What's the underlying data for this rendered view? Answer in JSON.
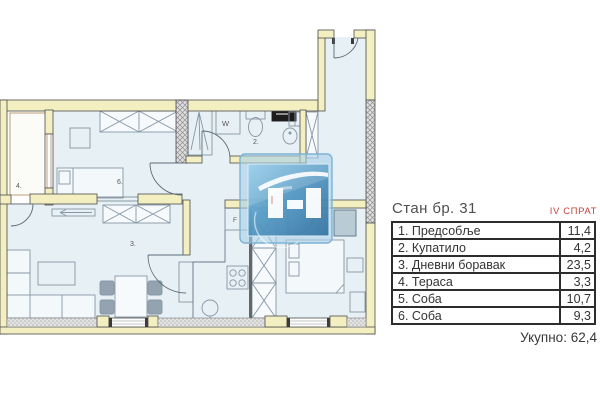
{
  "panel": {
    "title": "Стан бр. 31",
    "floor": "IV СПРАТ",
    "rows": [
      {
        "name": "1. Предсобље",
        "area": "11,4"
      },
      {
        "name": "2. Купатило",
        "area": "4,2"
      },
      {
        "name": "3. Дневни боравак",
        "area": "23,5"
      },
      {
        "name": "4. Тераса",
        "area": "3,3"
      },
      {
        "name": "5. Соба",
        "area": "10,7"
      },
      {
        "name": "6. Соба",
        "area": "9,3"
      }
    ],
    "total_label": "Укупно:",
    "total_value": "62,4"
  },
  "plan": {
    "room_labels": {
      "terrace": "4.",
      "bedroom6": "6.",
      "living": "3.",
      "bathroom": "2."
    },
    "appliance_labels": {
      "washer": "W",
      "fridge": "F"
    },
    "colors": {
      "wall_fill": "#f3efc0",
      "wall_outline": "#4d4d4d",
      "room_fill": "#e7f0f4",
      "furniture_line": "#8796a6",
      "accent_red": "#c3453c",
      "table_border": "#2d2d2d",
      "logo_blue_light": "#85c6e8",
      "logo_blue_dark": "#2d6d9c"
    }
  }
}
